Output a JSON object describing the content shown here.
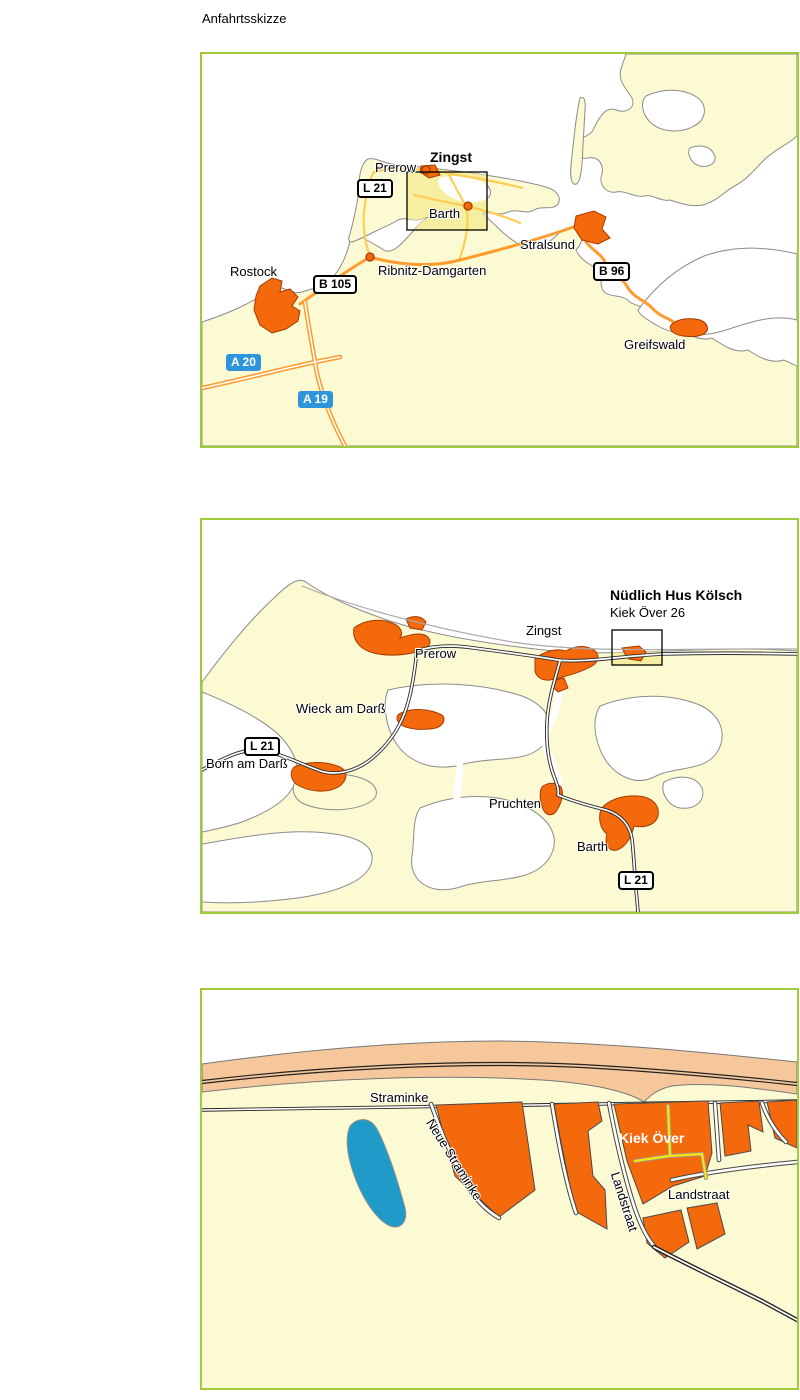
{
  "title": "Anfahrtsskizze",
  "map1": {
    "towns": {
      "rostock": "Rostock",
      "ribnitz_damgarten": "Ribnitz-Damgarten",
      "prerow": "Prerow",
      "zingst": "Zingst",
      "barth": "Barth",
      "stralsund": "Stralsund",
      "greifswald": "Greifswald"
    },
    "signs": {
      "l21": "L 21",
      "b105": "B 105",
      "b96": "B 96",
      "a20": "A 20",
      "a19": "A 19"
    }
  },
  "map2": {
    "venue": {
      "name": "Nüdlich Hus Kölsch",
      "street": "Kiek Över 26"
    },
    "towns": {
      "zingst": "Zingst",
      "prerow": "Prerow",
      "wieck_am_darss": "Wieck am Darß",
      "born_am_darss": "Born am Darß",
      "pruchten": "Pruchten",
      "barth": "Barth"
    },
    "signs": {
      "l21_west": "L 21",
      "l21_south": "L 21"
    }
  },
  "map3": {
    "streets": {
      "straminke": "Straminke",
      "neue_straminke": "Neue Straminke",
      "kiek_over": "Kiek Över",
      "landstraat_along": "Landstraat",
      "landstraat_label": "Landstraat"
    }
  },
  "colors": {
    "map_border": "#9DCB3C",
    "land": "#FCFAD2",
    "water": "#FFFFFF",
    "highlight_area": "#F6EFA2",
    "town_orange": "#F5690D",
    "federal_road_orange": "#FF9B2E",
    "minor_road_yellow": "#FFCC55",
    "motorway_sign_blue": "#2E95DC",
    "dune_sand": "#F6C79B",
    "pond_blue": "#1F9AC9",
    "route_highlight_yellow": "#FFE600"
  }
}
